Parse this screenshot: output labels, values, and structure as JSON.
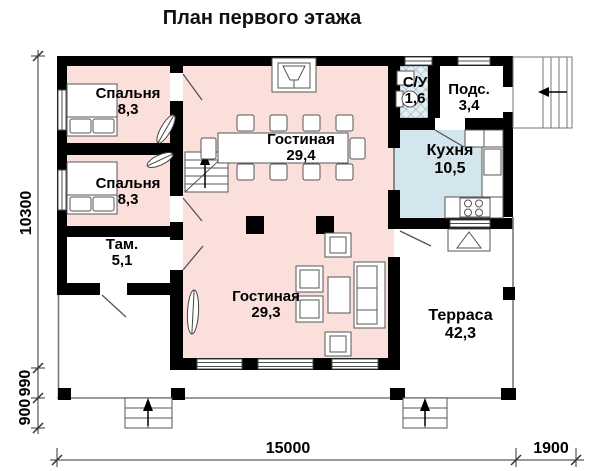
{
  "title": "План первого этажа",
  "rooms": [
    {
      "id": "bedroom-1",
      "name": "Спальня",
      "area": "8,3"
    },
    {
      "id": "bedroom-2",
      "name": "Спальня",
      "area": "8,3"
    },
    {
      "id": "living-upper",
      "name": "Гостиная",
      "area": "29,4"
    },
    {
      "id": "bathroom",
      "name": "С/У",
      "area": "1,6"
    },
    {
      "id": "pantry",
      "name": "Подс.",
      "area": "3,4"
    },
    {
      "id": "kitchen",
      "name": "Кухня",
      "area": "10,5"
    },
    {
      "id": "vestibule",
      "name": "Там.",
      "area": "5,1"
    },
    {
      "id": "living-lower",
      "name": "Гостиная",
      "area": "29,3"
    },
    {
      "id": "terrace",
      "name": "Терраса",
      "area": "42,3"
    }
  ],
  "dimensions": {
    "height_total": "10300",
    "height_seg_upper": "990",
    "height_seg_lower": "900",
    "width_main": "15000",
    "width_entry": "1900"
  },
  "colors": {
    "room_pink": "#fadfdb",
    "kitchen_blue": "#d4e6ed",
    "bath_blue": "#e3edf2",
    "wall": "#000000",
    "line": "#4d4d4d"
  }
}
